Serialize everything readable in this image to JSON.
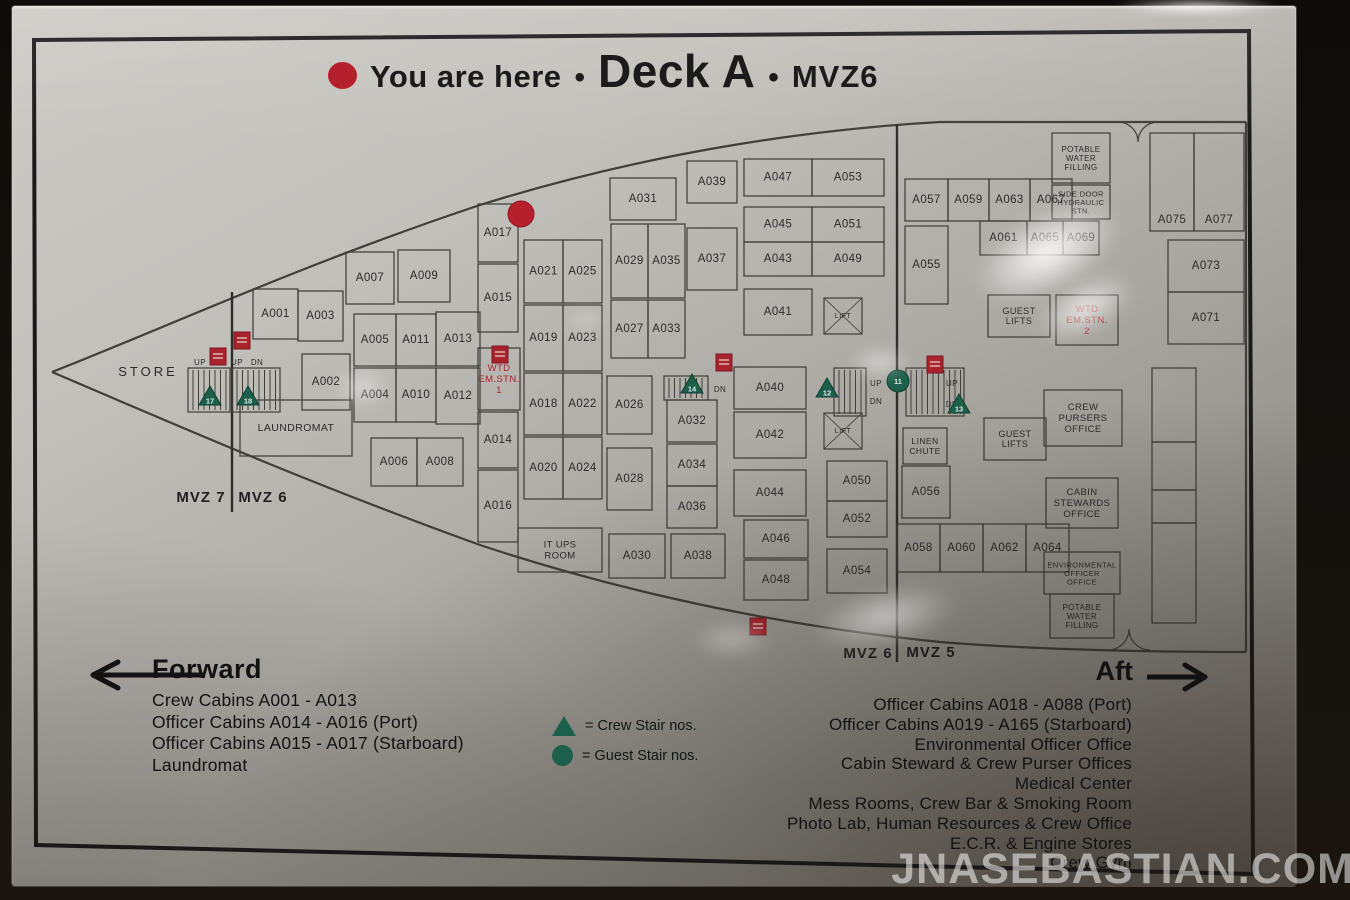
{
  "title": {
    "you_are_here": "You are here",
    "bullet": "•",
    "deck": "Deck A",
    "mvz": "MVZ6"
  },
  "colors": {
    "sign_silver": "#b9b6b1",
    "ink": "#403e3a",
    "label_ink": "#2b2b2b",
    "red": "#a8232c",
    "red_bright": "#b5202c",
    "green": "#1c5f4a",
    "frame": "#1a1a1a",
    "text": "#141414"
  },
  "legend": {
    "crew_label": "= Crew Stair nos.",
    "guest_label": "= Guest Stair nos.",
    "crew_symbol": "green-triangle",
    "guest_symbol": "green-circle"
  },
  "forward": {
    "heading": "Forward",
    "items": [
      "Crew Cabins A001 - A013",
      "Officer Cabins A014 - A016 (Port)",
      "Officer Cabins A015 - A017 (Starboard)",
      "Laundromat"
    ]
  },
  "aft": {
    "heading": "Aft",
    "items": [
      "Officer Cabins A018 - A088 (Port)",
      "Officer Cabins A019 - A165 (Starboard)",
      "Environmental Officer Office",
      "Cabin Steward & Crew Purser Offices",
      "Medical Center",
      "Mess Rooms, Crew Bar & Smoking Room",
      "Photo Lab, Human Resources & Crew Office",
      "E.C.R. & Engine Stores",
      "Crew Gym"
    ]
  },
  "watermark": "JNASEBASTIAN.COM",
  "map": {
    "frame": "34,40 1249,31 1253,874 36,845",
    "hull": [
      "M 52 372 C 160 330 300 265 480 205 C 640 155 800 130 940 122 L 1246 122",
      "M 52 372 C 160 418 300 480 480 545 C 640 598 800 628 940 642 C 1040 650 1150 652 1246 652",
      "M 1246 122 L 1246 652"
    ],
    "mvz_lines": [
      {
        "x": 232,
        "y1": 292,
        "y2": 512
      },
      {
        "x": 897,
        "y1": 125,
        "y2": 662
      }
    ],
    "mvz_labels": [
      {
        "t": "MVZ 7",
        "x": 201,
        "y": 497
      },
      {
        "t": "MVZ 6",
        "x": 263,
        "y": 497
      },
      {
        "t": "MVZ 6",
        "x": 868,
        "y": 653
      },
      {
        "t": "MVZ 5",
        "x": 931,
        "y": 652
      }
    ],
    "rooms": [
      {
        "t": "A001",
        "x": 253,
        "y": 289,
        "w": 45,
        "h": 50
      },
      {
        "t": "A003",
        "x": 298,
        "y": 291,
        "w": 45,
        "h": 50
      },
      {
        "t": "A007",
        "x": 346,
        "y": 252,
        "w": 48,
        "h": 52
      },
      {
        "t": "A009",
        "x": 398,
        "y": 250,
        "w": 52,
        "h": 52
      },
      {
        "t": "A005",
        "x": 354,
        "y": 314,
        "w": 42,
        "h": 52
      },
      {
        "t": "A011",
        "x": 396,
        "y": 314,
        "w": 40,
        "h": 52
      },
      {
        "t": "A013",
        "x": 436,
        "y": 312,
        "w": 44,
        "h": 54
      },
      {
        "t": "A002",
        "x": 302,
        "y": 354,
        "w": 48,
        "h": 56
      },
      {
        "t": "A004",
        "x": 354,
        "y": 368,
        "w": 42,
        "h": 54
      },
      {
        "t": "A010",
        "x": 396,
        "y": 368,
        "w": 40,
        "h": 54
      },
      {
        "t": "A012",
        "x": 436,
        "y": 368,
        "w": 44,
        "h": 56
      },
      {
        "t": "LAUNDROMAT",
        "x": 240,
        "y": 400,
        "w": 112,
        "h": 56,
        "fs": 10.5
      },
      {
        "t": "A006",
        "x": 371,
        "y": 438,
        "w": 46,
        "h": 48
      },
      {
        "t": "A008",
        "x": 417,
        "y": 438,
        "w": 46,
        "h": 48
      },
      {
        "t": "A017",
        "x": 478,
        "y": 204,
        "w": 40,
        "h": 58
      },
      {
        "t": "A015",
        "x": 478,
        "y": 264,
        "w": 40,
        "h": 68
      },
      {
        "t": "WTD\nEM.STN.\n1",
        "x": 478,
        "y": 348,
        "w": 42,
        "h": 62,
        "c": "red",
        "fs": 9.5
      },
      {
        "t": "A014",
        "x": 478,
        "y": 412,
        "w": 40,
        "h": 56
      },
      {
        "t": "A016",
        "x": 478,
        "y": 470,
        "w": 40,
        "h": 72
      },
      {
        "t": "IT UPS\nROOM",
        "x": 518,
        "y": 528,
        "w": 84,
        "h": 44,
        "fs": 9.5
      },
      {
        "t": "A021",
        "x": 524,
        "y": 240,
        "w": 39,
        "h": 63
      },
      {
        "t": "A025",
        "x": 563,
        "y": 240,
        "w": 39,
        "h": 63
      },
      {
        "t": "A019",
        "x": 524,
        "y": 305,
        "w": 39,
        "h": 66
      },
      {
        "t": "A023",
        "x": 563,
        "y": 305,
        "w": 39,
        "h": 66
      },
      {
        "t": "A018",
        "x": 524,
        "y": 373,
        "w": 39,
        "h": 62
      },
      {
        "t": "A022",
        "x": 563,
        "y": 373,
        "w": 39,
        "h": 62
      },
      {
        "t": "A020",
        "x": 524,
        "y": 437,
        "w": 39,
        "h": 62
      },
      {
        "t": "A024",
        "x": 563,
        "y": 437,
        "w": 39,
        "h": 62
      },
      {
        "t": "A031",
        "x": 610,
        "y": 178,
        "w": 66,
        "h": 42
      },
      {
        "t": "A029",
        "x": 611,
        "y": 224,
        "w": 37,
        "h": 74
      },
      {
        "t": "A035",
        "x": 648,
        "y": 224,
        "w": 37,
        "h": 74
      },
      {
        "t": "A027",
        "x": 611,
        "y": 300,
        "w": 37,
        "h": 58
      },
      {
        "t": "A033",
        "x": 648,
        "y": 300,
        "w": 37,
        "h": 58
      },
      {
        "t": "A026",
        "x": 607,
        "y": 376,
        "w": 45,
        "h": 58
      },
      {
        "t": "A028",
        "x": 607,
        "y": 448,
        "w": 45,
        "h": 62
      },
      {
        "t": "A032",
        "x": 667,
        "y": 400,
        "w": 50,
        "h": 42
      },
      {
        "t": "A034",
        "x": 667,
        "y": 444,
        "w": 50,
        "h": 42
      },
      {
        "t": "A036",
        "x": 667,
        "y": 486,
        "w": 50,
        "h": 42
      },
      {
        "t": "A030",
        "x": 609,
        "y": 534,
        "w": 56,
        "h": 44
      },
      {
        "t": "A038",
        "x": 671,
        "y": 534,
        "w": 54,
        "h": 44
      },
      {
        "t": "A039",
        "x": 687,
        "y": 161,
        "w": 50,
        "h": 42
      },
      {
        "t": "A037",
        "x": 687,
        "y": 228,
        "w": 50,
        "h": 62
      },
      {
        "t": "A047",
        "x": 744,
        "y": 159,
        "w": 68,
        "h": 37
      },
      {
        "t": "A053",
        "x": 812,
        "y": 159,
        "w": 72,
        "h": 37
      },
      {
        "t": "A045",
        "x": 744,
        "y": 207,
        "w": 68,
        "h": 35
      },
      {
        "t": "A051",
        "x": 812,
        "y": 207,
        "w": 72,
        "h": 35
      },
      {
        "t": "A043",
        "x": 744,
        "y": 242,
        "w": 68,
        "h": 34
      },
      {
        "t": "A049",
        "x": 812,
        "y": 242,
        "w": 72,
        "h": 34
      },
      {
        "t": "A041",
        "x": 744,
        "y": 289,
        "w": 68,
        "h": 46
      },
      {
        "t": "A040",
        "x": 734,
        "y": 367,
        "w": 72,
        "h": 42
      },
      {
        "t": "A042",
        "x": 734,
        "y": 412,
        "w": 72,
        "h": 46
      },
      {
        "t": "A044",
        "x": 734,
        "y": 470,
        "w": 72,
        "h": 46
      },
      {
        "t": "A046",
        "x": 744,
        "y": 520,
        "w": 64,
        "h": 38
      },
      {
        "t": "A048",
        "x": 744,
        "y": 560,
        "w": 64,
        "h": 40
      },
      {
        "t": "A050",
        "x": 827,
        "y": 461,
        "w": 60,
        "h": 40
      },
      {
        "t": "A052",
        "x": 827,
        "y": 501,
        "w": 60,
        "h": 36
      },
      {
        "t": "A054",
        "x": 827,
        "y": 549,
        "w": 60,
        "h": 44
      },
      {
        "t": "A057",
        "x": 905,
        "y": 179,
        "w": 43,
        "h": 42
      },
      {
        "t": "A059",
        "x": 948,
        "y": 179,
        "w": 41,
        "h": 42
      },
      {
        "t": "A063",
        "x": 989,
        "y": 179,
        "w": 41,
        "h": 42
      },
      {
        "t": "A067",
        "x": 1030,
        "y": 179,
        "w": 42,
        "h": 42
      },
      {
        "t": "A061",
        "x": 980,
        "y": 221,
        "w": 47,
        "h": 34
      },
      {
        "t": "A065",
        "x": 1027,
        "y": 221,
        "w": 36,
        "h": 34
      },
      {
        "t": "A069",
        "x": 1063,
        "y": 221,
        "w": 36,
        "h": 34
      },
      {
        "t": "A055",
        "x": 905,
        "y": 226,
        "w": 43,
        "h": 78
      },
      {
        "t": "POTABLE\nWATER\nFILLING",
        "x": 1052,
        "y": 133,
        "w": 58,
        "h": 50,
        "fs": 8
      },
      {
        "t": "SIDE DOOR\nHYDRAULIC\nSTN.",
        "x": 1052,
        "y": 185,
        "w": 58,
        "h": 34,
        "fs": 7.5
      },
      {
        "t": "GUEST\nLIFTS",
        "x": 988,
        "y": 295,
        "w": 62,
        "h": 42,
        "fs": 9
      },
      {
        "t": "WTD\nEM.STN.\n2",
        "x": 1056,
        "y": 295,
        "w": 62,
        "h": 50,
        "c": "red",
        "fs": 9.5
      },
      {
        "t": "A075",
        "x": 1150,
        "y": 133,
        "w": 44,
        "h": 98,
        "ly": 220
      },
      {
        "t": "A077",
        "x": 1194,
        "y": 133,
        "w": 50,
        "h": 98,
        "ly": 220
      },
      {
        "t": "A073",
        "x": 1168,
        "y": 240,
        "w": 76,
        "h": 52
      },
      {
        "t": "A071",
        "x": 1168,
        "y": 292,
        "w": 76,
        "h": 52
      },
      {
        "t": "CREW\nPURSERS\nOFFICE",
        "x": 1044,
        "y": 390,
        "w": 78,
        "h": 56,
        "fs": 9.5
      },
      {
        "t": "GUEST\nLIFTS",
        "x": 984,
        "y": 418,
        "w": 62,
        "h": 42,
        "fs": 9
      },
      {
        "t": "LINEN\nCHUTE",
        "x": 903,
        "y": 428,
        "w": 44,
        "h": 36,
        "fs": 8.5
      },
      {
        "t": "A056",
        "x": 902,
        "y": 466,
        "w": 48,
        "h": 52
      },
      {
        "t": "CABIN\nSTEWARDS\nOFFICE",
        "x": 1046,
        "y": 478,
        "w": 72,
        "h": 50,
        "fs": 9.5
      },
      {
        "t": "A058",
        "x": 897,
        "y": 524,
        "w": 43,
        "h": 48
      },
      {
        "t": "A060",
        "x": 940,
        "y": 524,
        "w": 43,
        "h": 48
      },
      {
        "t": "A062",
        "x": 983,
        "y": 524,
        "w": 43,
        "h": 48
      },
      {
        "t": "A064",
        "x": 1026,
        "y": 524,
        "w": 43,
        "h": 48
      },
      {
        "t": "ENVIRONMENTAL\nOFFICER\nOFFICE",
        "x": 1044,
        "y": 552,
        "w": 76,
        "h": 42,
        "fs": 7.5
      },
      {
        "t": "POTABLE\nWATER\nFILLING",
        "x": 1050,
        "y": 594,
        "w": 64,
        "h": 44,
        "fs": 8
      },
      {
        "t": "",
        "x": 1152,
        "y": 368,
        "w": 44,
        "h": 74
      },
      {
        "t": "",
        "x": 1152,
        "y": 442,
        "w": 44,
        "h": 48
      },
      {
        "t": "",
        "x": 1152,
        "y": 490,
        "w": 44,
        "h": 33
      },
      {
        "t": "",
        "x": 1152,
        "y": 523,
        "w": 44,
        "h": 100
      }
    ],
    "texts": [
      {
        "t": "STORE",
        "x": 148,
        "y": 371,
        "fs": 13,
        "ls": 3
      },
      {
        "t": "UP",
        "x": 200,
        "y": 362,
        "fs": 8
      },
      {
        "t": "UP",
        "x": 237,
        "y": 362,
        "fs": 8
      },
      {
        "t": "DN",
        "x": 257,
        "y": 362,
        "fs": 8
      },
      {
        "t": "DN",
        "x": 720,
        "y": 389,
        "fs": 8
      },
      {
        "t": "UP",
        "x": 876,
        "y": 383,
        "fs": 8
      },
      {
        "t": "DN",
        "x": 876,
        "y": 401,
        "fs": 8
      },
      {
        "t": "UP",
        "x": 952,
        "y": 383,
        "fs": 8
      },
      {
        "t": "DN",
        "x": 952,
        "y": 404,
        "fs": 8
      }
    ],
    "stairs": [
      {
        "x": 188,
        "y": 368,
        "w": 42,
        "h": 44
      },
      {
        "x": 232,
        "y": 368,
        "w": 48,
        "h": 44
      },
      {
        "x": 664,
        "y": 376,
        "w": 44,
        "h": 24
      },
      {
        "x": 834,
        "y": 368,
        "w": 32,
        "h": 48
      },
      {
        "x": 906,
        "y": 368,
        "w": 58,
        "h": 48
      }
    ],
    "lifts": [
      {
        "t": "LIFT",
        "x": 824,
        "y": 298,
        "w": 38,
        "h": 36
      },
      {
        "t": "LIFT",
        "x": 824,
        "y": 413,
        "w": 38,
        "h": 36
      }
    ],
    "fire_stations": [
      {
        "x": 210,
        "y": 348
      },
      {
        "x": 234,
        "y": 332
      },
      {
        "x": 492,
        "y": 346
      },
      {
        "x": 716,
        "y": 354
      },
      {
        "x": 927,
        "y": 356
      },
      {
        "x": 750,
        "y": 618
      }
    ],
    "markers": [
      {
        "s": "tri",
        "n": "17",
        "x": 210,
        "y": 398
      },
      {
        "s": "tri",
        "n": "18",
        "x": 248,
        "y": 398
      },
      {
        "s": "tri",
        "n": "14",
        "x": 692,
        "y": 386
      },
      {
        "s": "tri",
        "n": "12",
        "x": 827,
        "y": 390
      },
      {
        "s": "tri",
        "n": "13",
        "x": 959,
        "y": 406
      },
      {
        "s": "circ",
        "n": "11",
        "x": 898,
        "y": 381
      }
    ],
    "doors": [
      "M 1118 122 A 20 20 0 0 1 1138 142 M 1158 122 A 20 20 0 0 0 1138 142",
      "M 1108 650 A 21 21 0 0 0 1129 629 M 1150 650 A 21 21 0 0 1 1129 629"
    ],
    "you_are_here": {
      "x": 521,
      "y": 214,
      "r": 13
    }
  }
}
